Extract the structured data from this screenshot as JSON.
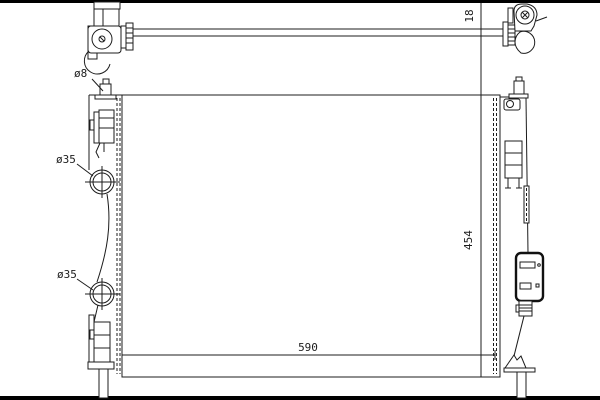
{
  "page": {
    "background": "#ffffff",
    "line_color": "#1c1c1c",
    "border_bar_color": "#000000",
    "kind": "radiator-technical-line-drawing"
  },
  "labels": {
    "crossbar_offset": "18",
    "bleed_port": "ø8",
    "upper_port": "ø35",
    "lower_port": "ø35",
    "core_height": "454",
    "core_width": "590"
  }
}
